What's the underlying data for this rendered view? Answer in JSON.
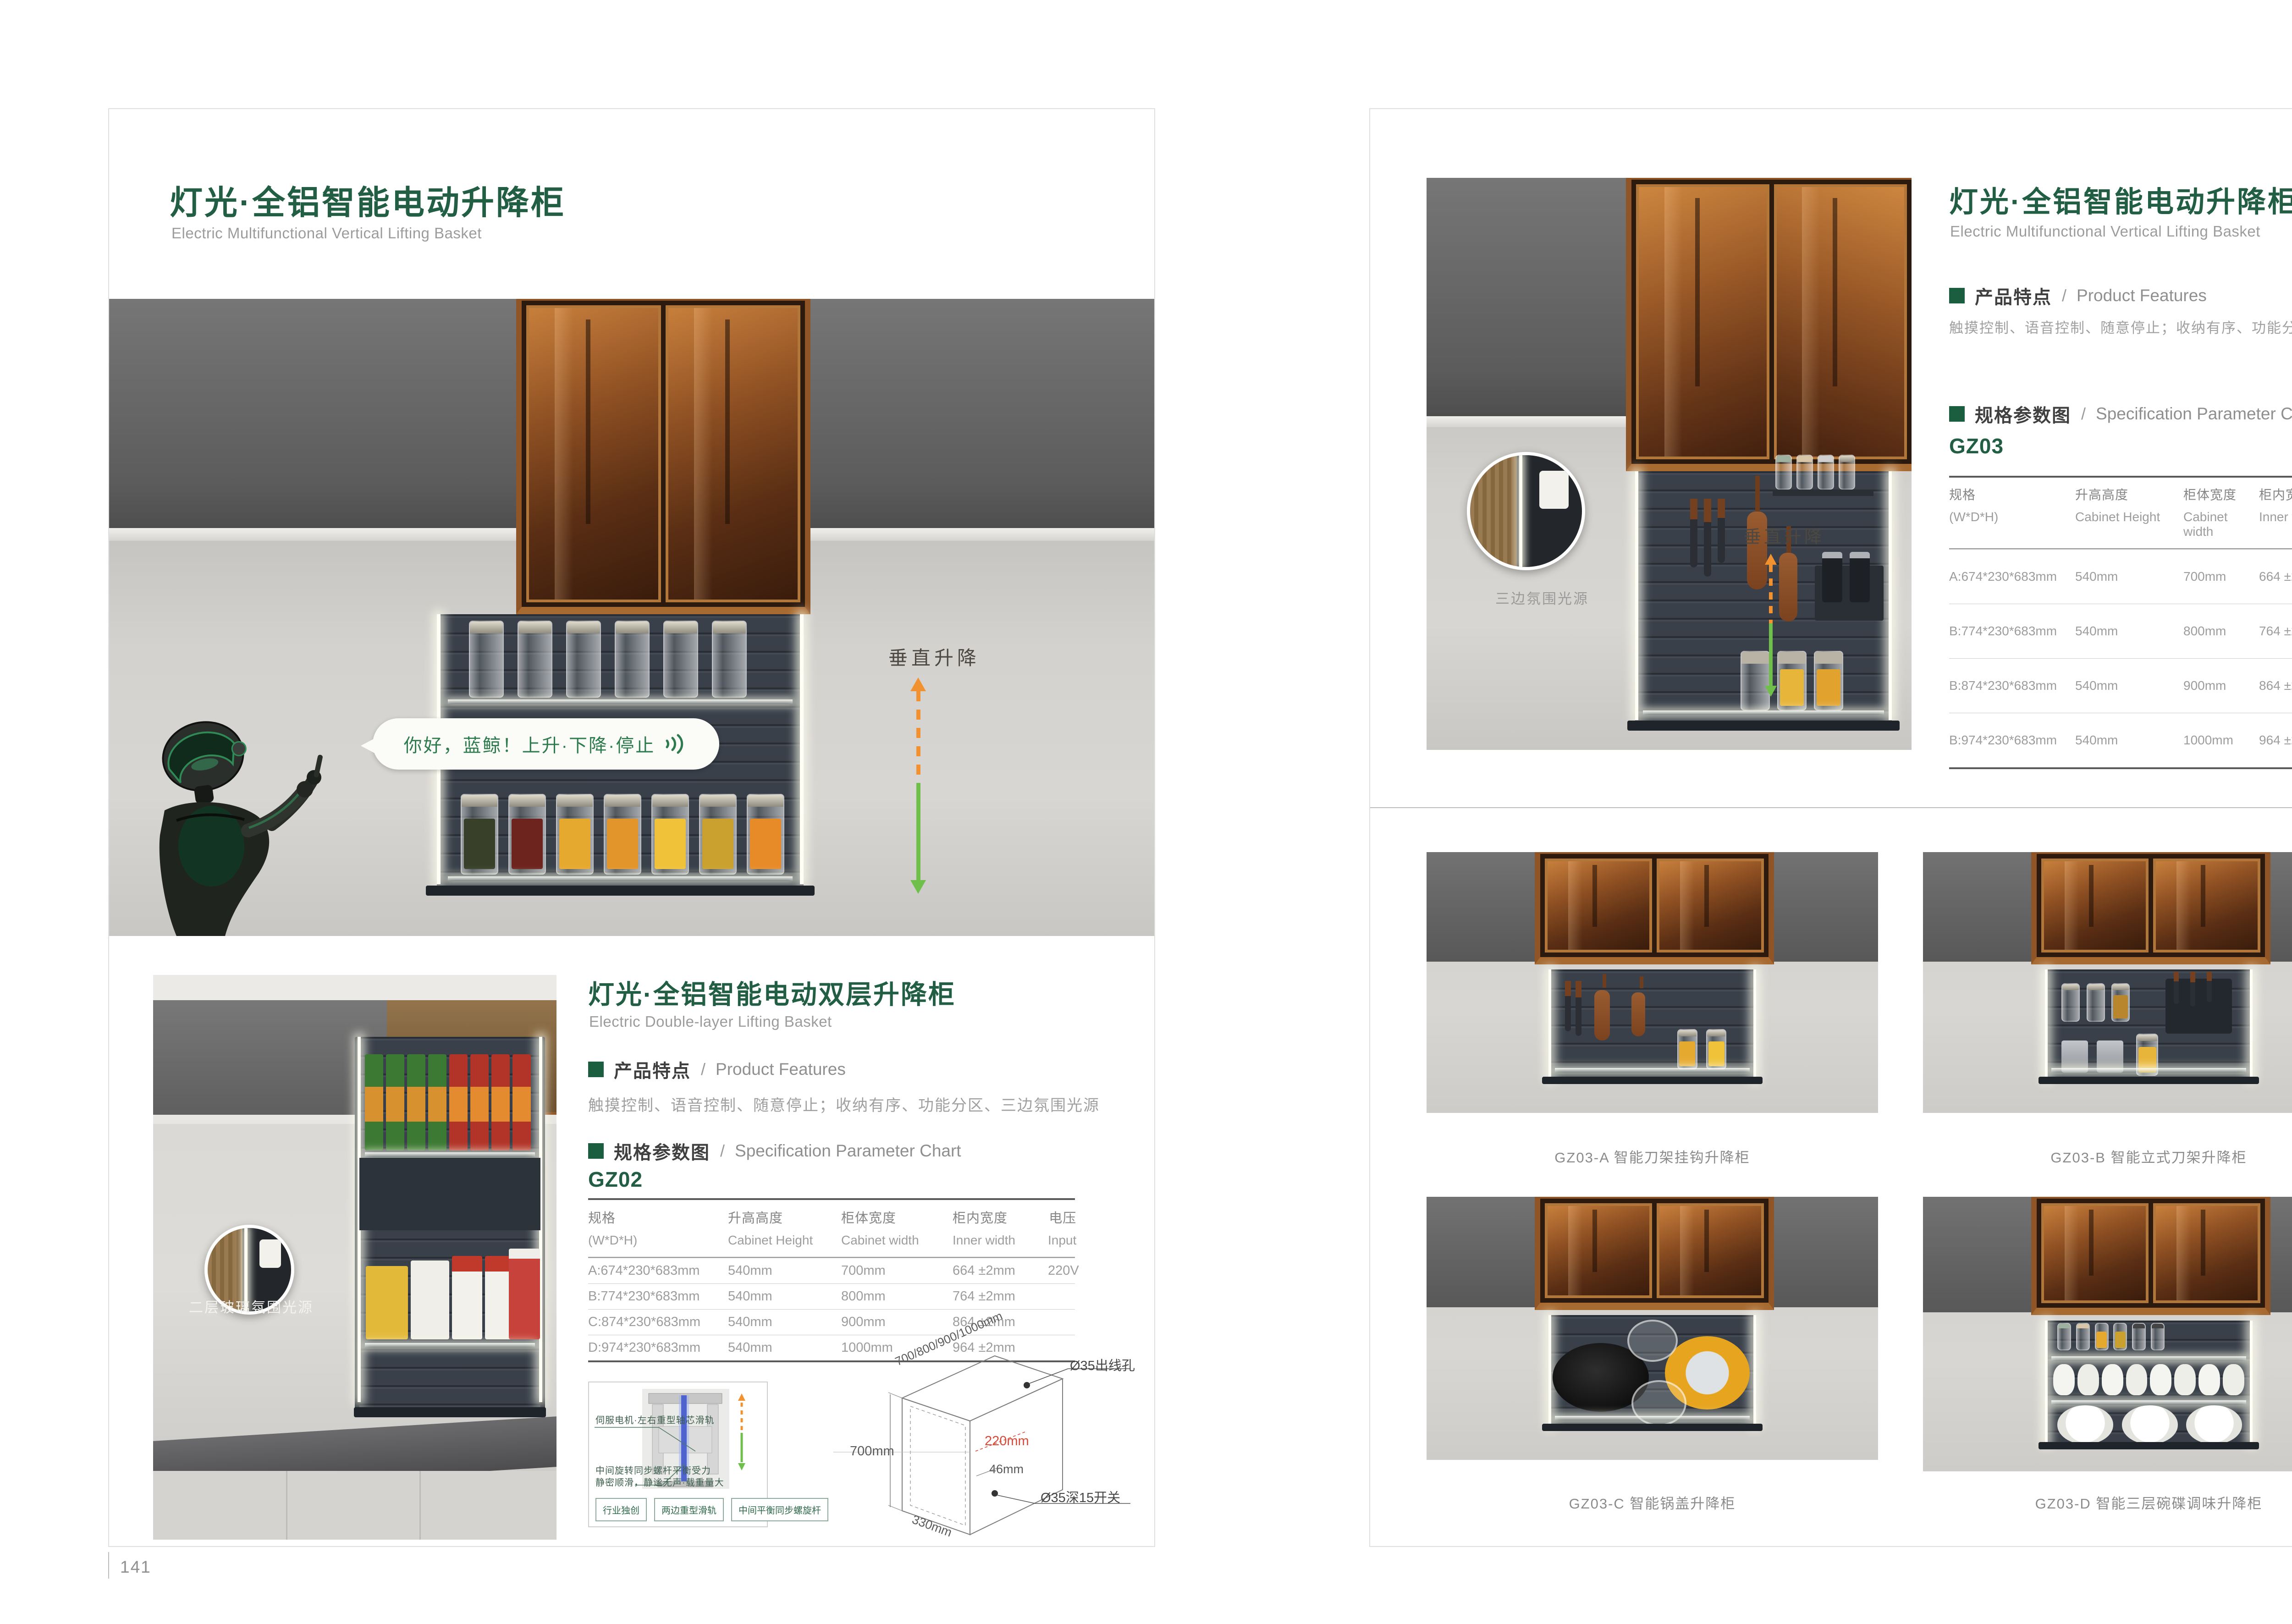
{
  "slash": "/",
  "accent_green": "#215e43",
  "arrow_orange": "#f29130",
  "arrow_green": "#6fbf4b",
  "left_page": {
    "page_number": "141",
    "title_zh": "灯光·全铝智能电动升降柜",
    "subtitle_en": "Electric Multifunctional Vertical Lifting Basket",
    "hero": {
      "speech_text": "你好，蓝鲸！上升·下降·停止",
      "motion_label": "垂直升降"
    },
    "secondary_label": "二层玻璃氛围光源",
    "section": {
      "title_zh": "灯光·全铝智能电动双层升降柜",
      "subtitle_en": "Electric Double-layer Lifting Basket",
      "features_zh": "产品特点",
      "features_en": "Product Features",
      "features_text": "触摸控制、语音控制、随意停止；收纳有序、功能分区、三边氛围光源",
      "spec_zh": "规格参数图",
      "spec_en": "Specification Parameter Chart",
      "model": "GZ02",
      "table": {
        "headers": [
          {
            "zh": "规格",
            "en": "(W*D*H)"
          },
          {
            "zh": "升高高度",
            "en": "Cabinet Height"
          },
          {
            "zh": "柜体宽度",
            "en": "Cabinet width"
          },
          {
            "zh": "柜内宽度",
            "en": "Inner width"
          },
          {
            "zh": "电压",
            "en": "Input"
          }
        ],
        "rows": [
          [
            "A:674*230*683mm",
            "540mm",
            "700mm",
            "664 ±2mm",
            "220V"
          ],
          [
            "B:774*230*683mm",
            "540mm",
            "800mm",
            "764 ±2mm",
            ""
          ],
          [
            "C:874*230*683mm",
            "540mm",
            "900mm",
            "864 ±2mm",
            ""
          ],
          [
            "D:974*230*683mm",
            "540mm",
            "1000mm",
            "964 ±2mm",
            ""
          ]
        ]
      }
    },
    "inset": {
      "label_top": "伺服电机·左右重型轴芯滑轨",
      "label_bottom_1": "中间旋转同步螺杆平衡受力",
      "label_bottom_2": "静密顺滑，静谧无声·载重量大",
      "tags": [
        "行业独创",
        "两边重型滑轨",
        "中间平衡同步螺旋杆"
      ]
    },
    "diagram": {
      "top_width": "700/800/900/1000mm",
      "wire_hole": "Ø35出线孔",
      "height": "700mm",
      "inner_depth": "220mm",
      "offset": "46mm",
      "switch_hole": "Ø35深15开关",
      "depth": "330mm"
    }
  },
  "right_page": {
    "page_number": "142",
    "title_zh": "灯光·全铝智能电动升降柜",
    "subtitle_en": "Electric Multifunctional Vertical Lifting Basket",
    "features_zh": "产品特点",
    "features_en": "Product Features",
    "features_text": "触摸控制、语音控制、随意停止；收纳有序、功能分区、三边氛围光源",
    "spec_zh": "规格参数图",
    "spec_en": "Specification Parameter Chart",
    "model": "GZ03",
    "callout_label": "三边氛围光源",
    "motion_label": "垂直升降",
    "table": {
      "headers": [
        {
          "zh": "规格",
          "en": "(W*D*H)"
        },
        {
          "zh": "升高高度",
          "en": "Cabinet Height"
        },
        {
          "zh": "柜体宽度",
          "en": "Cabinet width"
        },
        {
          "zh": "柜内宽度",
          "en": "Inner width"
        },
        {
          "zh": "电压",
          "en": "Input"
        }
      ],
      "rows": [
        [
          "A:674*230*683mm",
          "540mm",
          "700mm",
          "664 ±2mm",
          "220V"
        ],
        [
          "B:774*230*683mm",
          "540mm",
          "800mm",
          "764 ±2mm",
          ""
        ],
        [
          "B:874*230*683mm",
          "540mm",
          "900mm",
          "864 ±2mm",
          ""
        ],
        [
          "B:974*230*683mm",
          "540mm",
          "1000mm",
          "964 ±2mm",
          ""
        ]
      ]
    },
    "grid": [
      {
        "caption": "GZ03-A 智能刀架挂钩升降柜"
      },
      {
        "caption": "GZ03-B 智能立式刀架升降柜"
      },
      {
        "caption": "GZ03-C 智能锅盖升降柜"
      },
      {
        "caption": "GZ03-D 智能三层碗碟调味升降柜"
      }
    ]
  }
}
